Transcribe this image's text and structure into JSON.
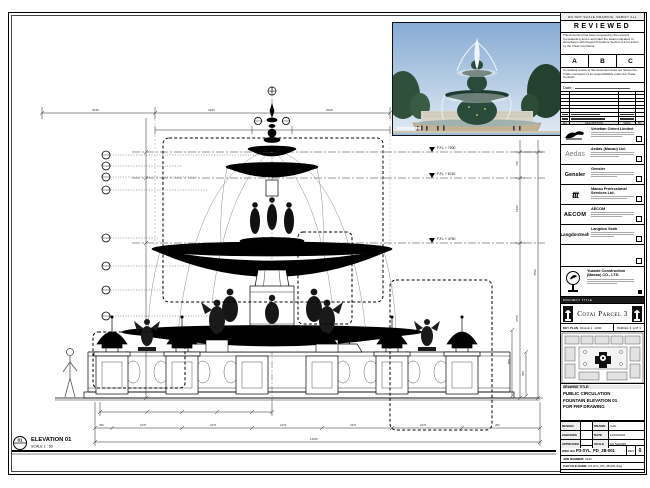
{
  "sheet": {
    "note_strip": "DO NOT SCALE DRAWING. VERIFY ALL DIMENSIONS ON SITE."
  },
  "stamp": {
    "title": "REVIEWED",
    "para1": "This document has been reviewed by the relevant Consultant(s) and is accorded the status indicated, in accordance with Project Procedure Section 5.4 for action by the Trade Contractor.",
    "statuses": [
      "A",
      "B",
      "C"
    ],
    "para2": "Consultant review of this document does not relieve the Trade Contractor of its responsibilities under the Trade Contract.",
    "date_label": "Date :"
  },
  "revision_table": {
    "headers": [
      "NO.",
      "DATE",
      "DESCRIPTION",
      "BY"
    ]
  },
  "consultants": [
    {
      "name": "Venetian Orient Limited"
    },
    {
      "logo": "Aedas",
      "name": "Aedas (Macau) Ltd."
    },
    {
      "logo": "Gensler",
      "name": "Gensler"
    },
    {
      "logo": "ttt",
      "name": "Macau Professional Services Ltd."
    },
    {
      "logo": "AECOM",
      "name": "AECOM"
    },
    {
      "logo": "LangdonSeah",
      "name": "Langdon Seah"
    }
  ],
  "contractor": {
    "name_line1": "Yuande Construction",
    "name_line2": "(Macau) CO., LTD."
  },
  "project": {
    "label": "PROJECT TITLE",
    "name": "Cotai Parcel 3"
  },
  "key_plan": {
    "label": "KEY PLAN",
    "scale": "SCALE 1 : 1000",
    "zone": "PARCEL 3, LOT 3"
  },
  "drawing_title": {
    "label": "DRAWING TITLE:",
    "line1": "PUBLIC CIRCULATION",
    "line2": "FOUNTAIN ELEVATION 01",
    "line3": "FOR FRP DRAWING"
  },
  "signoff": {
    "r1": [
      "DESIGN",
      "",
      "DRAWN",
      "CAD"
    ],
    "r2": [
      "CHECKED",
      "-",
      "DATE",
      "12/04/2016"
    ],
    "r3": [
      "APPROVED",
      "-",
      "SCALE",
      "AS SHOWN"
    ]
  },
  "numbers": {
    "dwg_label": "DWG NO.",
    "dwg_no": "P3-SYL_PD_JB-001",
    "rev_label": "REV",
    "rev": "0",
    "job_label": "JOB NUMBER:",
    "job": "3123",
    "cad_label": "CAD FILE NAME:",
    "cad": "P3-SYL_PD_JB-001.dwg",
    "ref_label": "REFERENCE DWG FILE NAME:"
  },
  "drawing": {
    "tag": "01",
    "label": "ELEVATION 01",
    "scale": "SCALE 1 : 50",
    "levels": [
      "F.F.L + 7500",
      "F.F.L + 6740",
      "F.F.L + 4750",
      "F.F.L"
    ],
    "dims": {
      "v1": "760",
      "v2": "1990",
      "v3": "4750",
      "v4": "7500",
      "t1": "2640",
      "t2": "1690",
      "t3": "2640",
      "b1": "450",
      "b2": "2470",
      "b3": "2470",
      "b4": "2470",
      "b5": "2470",
      "b6": "2470",
      "b7": "450",
      "total": "13250",
      "p1": "450",
      "p2": "800"
    }
  }
}
